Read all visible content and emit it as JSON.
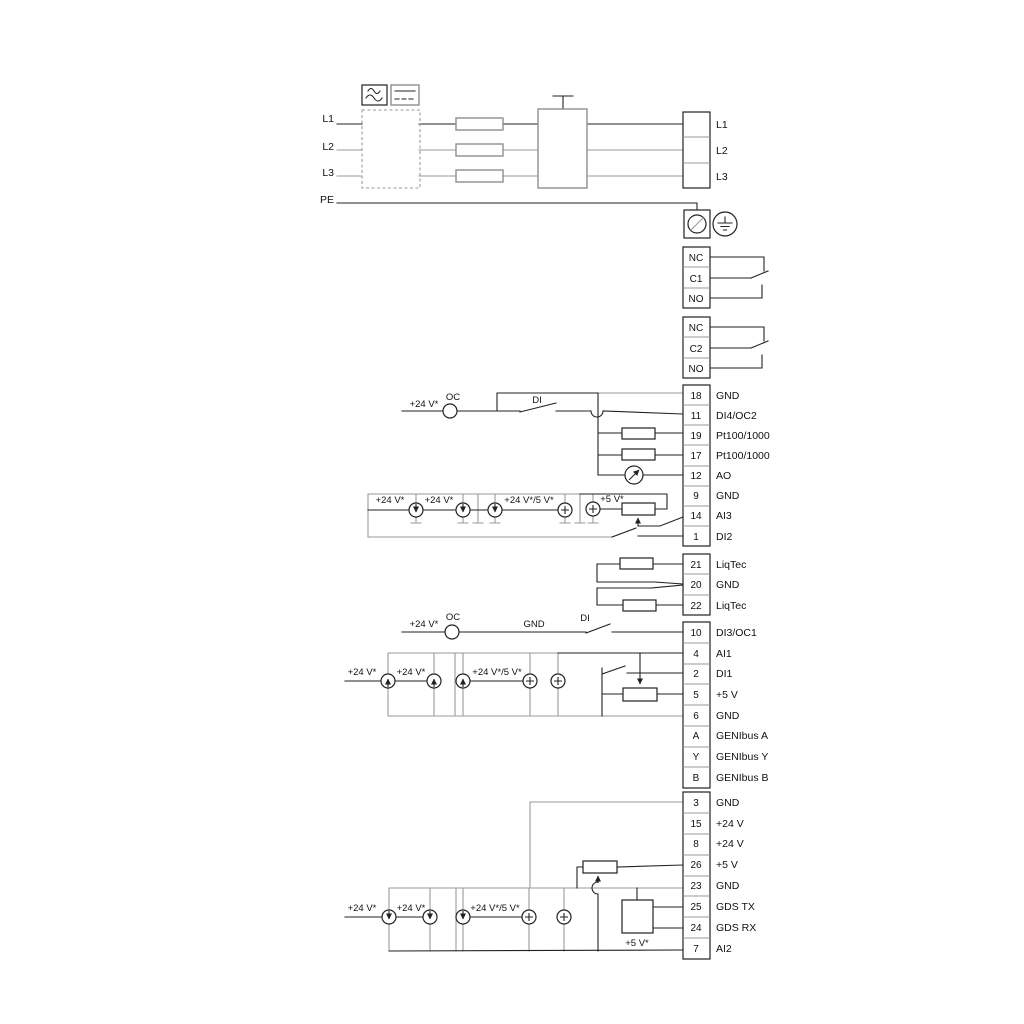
{
  "mains": {
    "in": [
      "L1",
      "L2",
      "L3"
    ],
    "pe": "PE",
    "out": [
      "L1",
      "L2",
      "L3"
    ]
  },
  "relays": [
    [
      "NC",
      "C1",
      "NO"
    ],
    [
      "NC",
      "C2",
      "NO"
    ]
  ],
  "upper": [
    {
      "n": "18",
      "l": "GND"
    },
    {
      "n": "11",
      "l": "DI4/OC2"
    },
    {
      "n": "19",
      "l": "Pt100/1000"
    },
    {
      "n": "17",
      "l": "Pt100/1000"
    },
    {
      "n": "12",
      "l": "AO"
    },
    {
      "n": "9",
      "l": "GND"
    },
    {
      "n": "14",
      "l": "AI3"
    },
    {
      "n": "1",
      "l": "DI2"
    }
  ],
  "liqtec": [
    {
      "n": "21",
      "l": "LiqTec"
    },
    {
      "n": "20",
      "l": "GND"
    },
    {
      "n": "22",
      "l": "LiqTec"
    }
  ],
  "middle": [
    {
      "n": "10",
      "l": "DI3/OC1"
    },
    {
      "n": "4",
      "l": "AI1"
    },
    {
      "n": "2",
      "l": "DI1"
    },
    {
      "n": "5",
      "l": "+5 V"
    },
    {
      "n": "6",
      "l": "GND"
    },
    {
      "n": "A",
      "l": "GENIbus A"
    },
    {
      "n": "Y",
      "l": "GENIbus Y"
    },
    {
      "n": "B",
      "l": "GENIbus B"
    }
  ],
  "bottom": [
    {
      "n": "3",
      "l": "GND"
    },
    {
      "n": "15",
      "l": "+24 V"
    },
    {
      "n": "8",
      "l": "+24 V"
    },
    {
      "n": "26",
      "l": "+5 V"
    },
    {
      "n": "23",
      "l": "GND"
    },
    {
      "n": "25",
      "l": "GDS TX"
    },
    {
      "n": "24",
      "l": "GDS RX"
    },
    {
      "n": "7",
      "l": "AI2"
    }
  ],
  "ann": {
    "v24": "+24 V*",
    "v24_5": "+24 V*/5 V*",
    "v5": "+5 V*",
    "oc": "OC",
    "di": "DI",
    "gnd": "GND"
  },
  "colors": {
    "wire": "#222222",
    "gray_wire": "#9a9a9a",
    "background": "#ffffff"
  }
}
